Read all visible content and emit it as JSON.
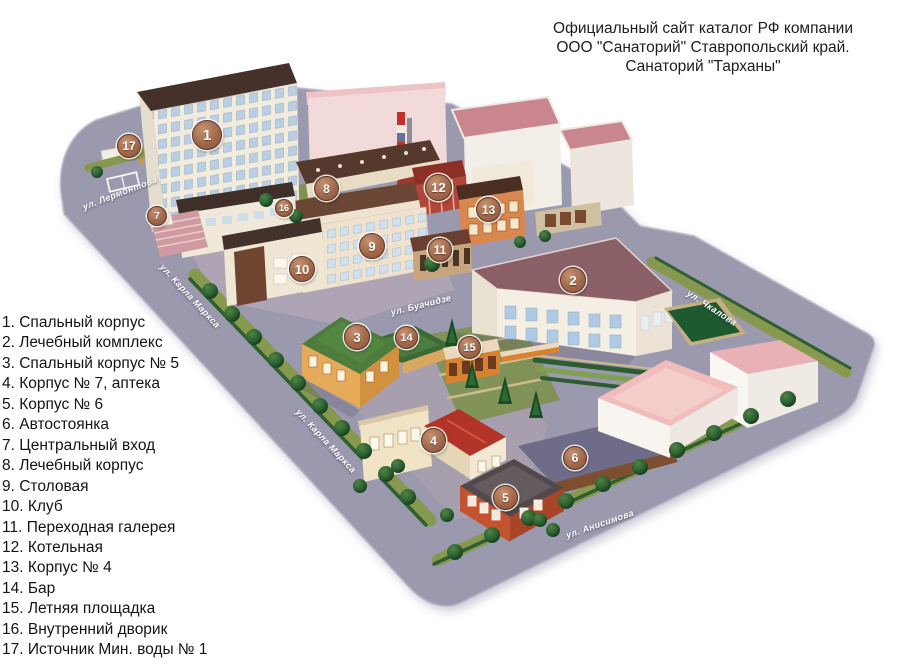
{
  "header": {
    "lines": [
      "Официальный сайт каталог РФ компании",
      "ООО \"Санаторий\" Ставропольский край.",
      "Санаторий \"Тарханы\""
    ]
  },
  "legend": {
    "items": [
      "1. Спальный корпус",
      "2. Лечебный комплекс",
      "3. Спальный корпус № 5",
      "4. Корпус № 7, аптека",
      "5. Корпус № 6",
      "6. Автостоянка",
      "7. Центральный вход",
      "8. Лечебный корпус",
      "9. Столовая",
      "10. Клуб",
      "11. Переходная галерея",
      "12. Котельная",
      "13. Корпус № 4",
      "14. Бар",
      "15. Летняя площадка",
      "16. Внутренний дворик",
      "17. Источник Мин. воды № 1"
    ]
  },
  "map": {
    "markers": [
      "1",
      "2",
      "3",
      "4",
      "5",
      "6",
      "7",
      "8",
      "9",
      "10",
      "11",
      "12",
      "13",
      "14",
      "15",
      "16",
      "17"
    ],
    "street_labels": [
      "ул. Лермонтова",
      "ул. Карла Маркса",
      "ул. Буачидзе",
      "ул. Чкалова",
      "ул. Карла Маркса",
      "ул. Анисимова"
    ],
    "colors": {
      "street_base": "#9b99ad",
      "marker_fill": "#a2684b",
      "marker_border": "#5d3a28",
      "lawn_green": "#87994f",
      "hedge_green": "#2f5e31",
      "tree_green": "#2c6133",
      "roof_dark_brown": "#46302a",
      "roof_mauve": "#8a5f66",
      "roof_green": "#4d7c3c",
      "roof_pink": "#f0bcbc",
      "building_white": "#f4eee1",
      "boiler_red": "#b2453a",
      "chimney_red": "#c03127",
      "parking_gray": "#6f6c8a"
    }
  }
}
